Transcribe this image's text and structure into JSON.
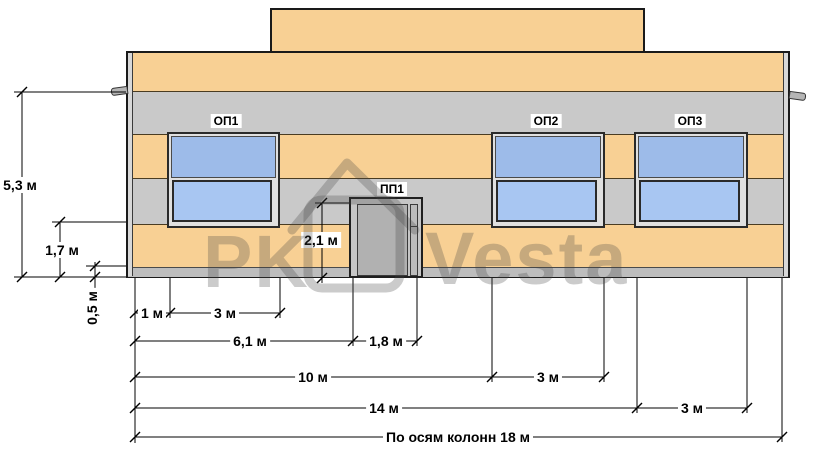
{
  "drawing": {
    "type": "building facade elevation",
    "labels": {
      "window1": "ОП1",
      "window2": "ОП2",
      "window3": "ОП3",
      "door": "ПП1"
    },
    "dimensions": {
      "vertical": {
        "total_height": "5,3 м",
        "upper_band_height": "1,7 м",
        "plinth_height": "0,5 м",
        "door_height": "2,1 м"
      },
      "horizontal": {
        "row1": [
          "1 м",
          "3 м"
        ],
        "row2": [
          "6,1 м",
          "1,8 м"
        ],
        "row3": [
          "10 м",
          "3 м"
        ],
        "row4": [
          "14 м",
          "3 м"
        ],
        "row5": [
          "По осям колонн 18 м"
        ]
      }
    }
  },
  "watermark": {
    "part1": "PK",
    "part2": "Vesta"
  },
  "colors": {
    "facade_orange": "#f8d094",
    "band_gray": "#c9c9c9",
    "plinth_gray": "#bdbdbd",
    "glass_top": "#9dbbe9",
    "glass_bottom": "#a8c6f2",
    "door_gray": "#b1b1b1",
    "frame_dark": "#2a2a2a",
    "watermark_gray": "rgba(70,70,70,0.28)"
  }
}
